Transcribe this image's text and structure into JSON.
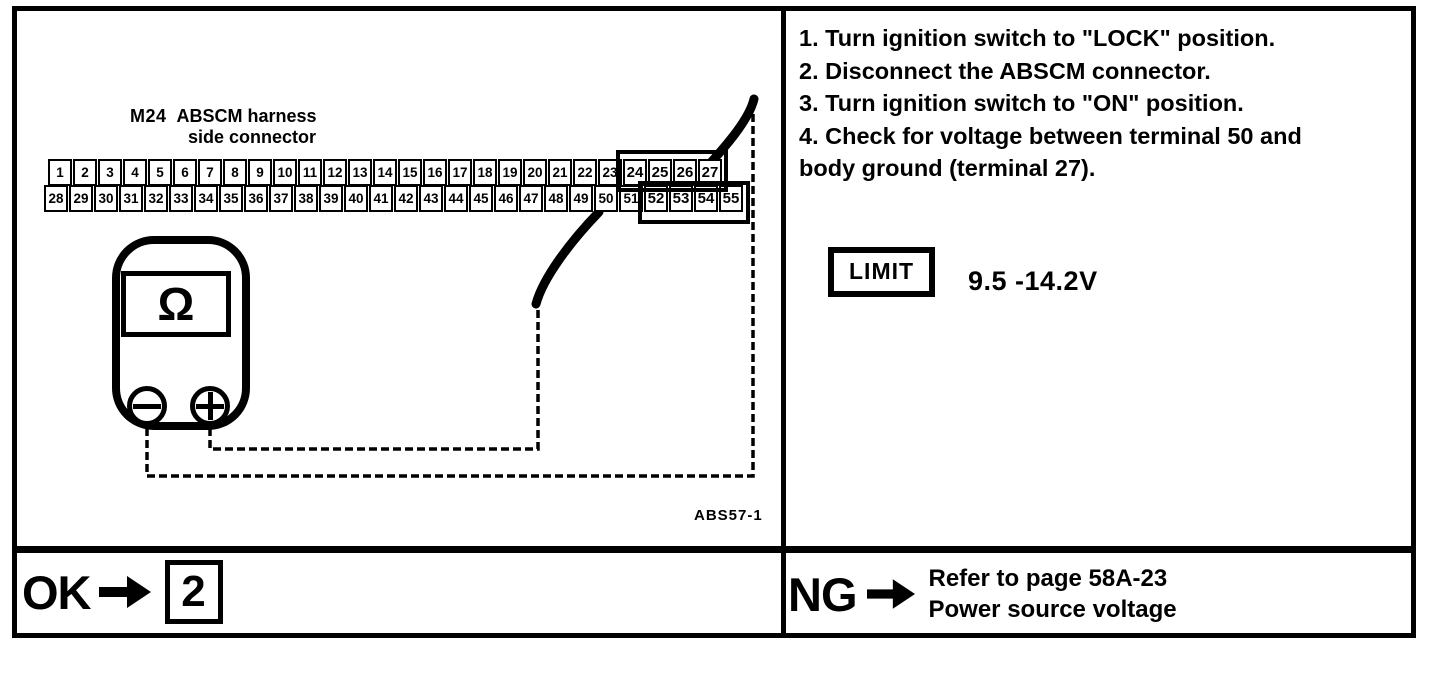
{
  "connector": {
    "code": "M24",
    "label_line1": "ABSCM harness",
    "label_line2": "side connector",
    "top_row": [
      "1",
      "2",
      "3",
      "4",
      "5",
      "6",
      "7",
      "8",
      "9",
      "10",
      "11",
      "12",
      "13",
      "14",
      "15",
      "16",
      "17",
      "18",
      "19",
      "20",
      "21",
      "22",
      "23",
      "24",
      "25",
      "26",
      "27"
    ],
    "bottom_row": [
      "28",
      "29",
      "30",
      "31",
      "32",
      "33",
      "34",
      "35",
      "36",
      "37",
      "38",
      "39",
      "40",
      "41",
      "42",
      "43",
      "44",
      "45",
      "46",
      "47",
      "48",
      "49",
      "50",
      "51",
      "52",
      "53",
      "54",
      "55"
    ],
    "highlight_top": [
      "24",
      "25",
      "26",
      "27"
    ],
    "highlight_bottom": [
      "52",
      "53",
      "54",
      "55"
    ]
  },
  "meter": {
    "display_symbol": "Ω"
  },
  "figure_code": "ABS57-1",
  "instructions": {
    "lines": [
      "1. Turn ignition switch to \"LOCK\" position.",
      "2. Disconnect the ABSCM connector.",
      "3. Turn ignition switch to \"ON\" position.",
      "4. Check for voltage between terminal 50 and",
      "body ground (terminal 27)."
    ]
  },
  "limit": {
    "label": "LIMIT",
    "value": "9.5 -14.2V"
  },
  "result_ok": {
    "label": "OK",
    "target": "2"
  },
  "result_ng": {
    "label": "NG",
    "line1": "Refer to page 58A-23",
    "line2": "Power source voltage"
  },
  "colors": {
    "ink": "#000000",
    "paper": "#ffffff"
  }
}
